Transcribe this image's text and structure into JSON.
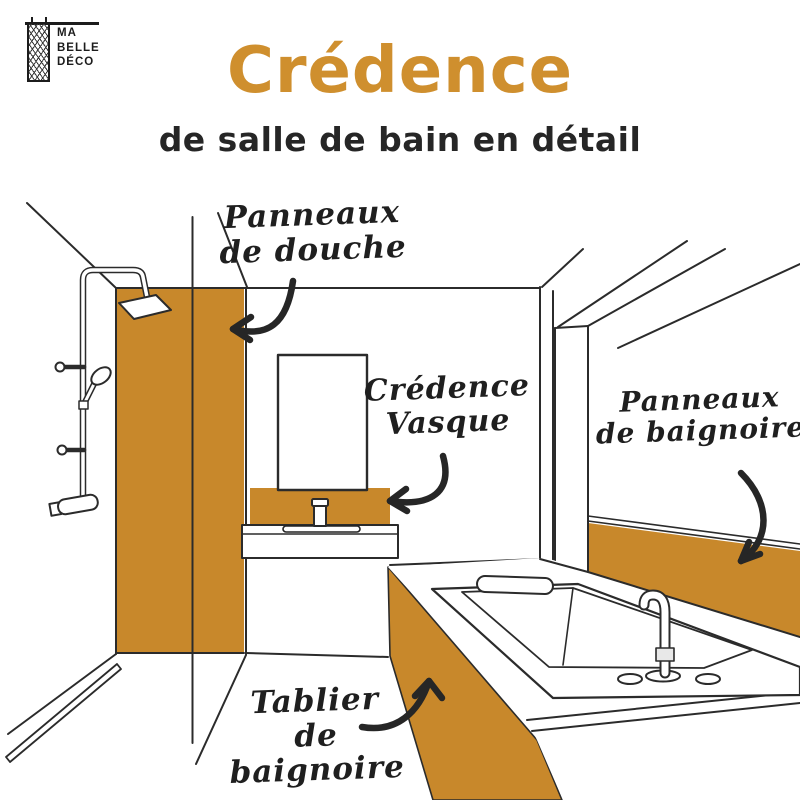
{
  "logo": {
    "line1": "MA",
    "line2": "BELLE",
    "line3": "DÉCO"
  },
  "header": {
    "title": "Crédence",
    "subtitle": "de salle de bain en détail"
  },
  "labels": {
    "shower_panels": "Panneaux\nde douche",
    "sink_splashback": "Crédence\nVasque",
    "bathtub_panels": "Panneaux\nde baignoire",
    "bathtub_apron": "Tablier\nde baignoire"
  },
  "colors": {
    "accent_orange": "#c8882b",
    "title_orange": "#cf8f2e",
    "ink": "#262626"
  }
}
